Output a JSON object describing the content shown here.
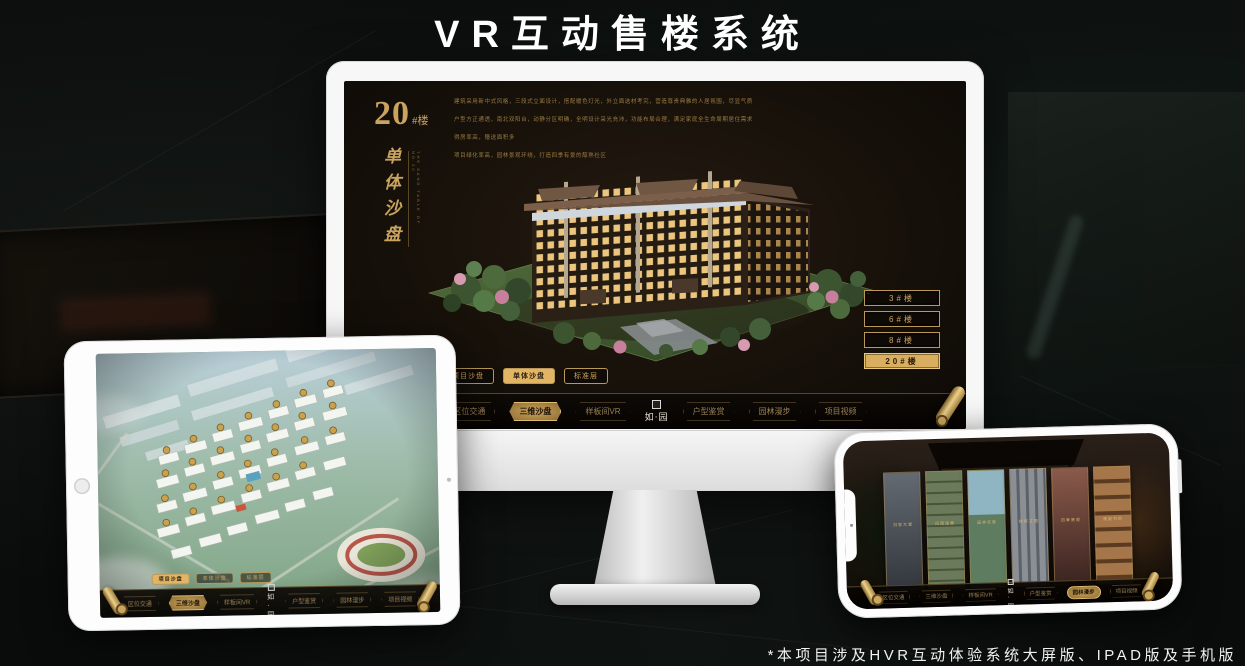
{
  "page": {
    "title": "VR互动售楼系统",
    "footnote": "*本项目涉及HVR互动体验系统大屏版、IPAD版及手机版"
  },
  "colors": {
    "gold": "#c9a45c",
    "gold_selected": "#e2b564",
    "screen_bg": "#17110a",
    "page_bg": "#0a0c0b"
  },
  "brand": {
    "logo": "如·园"
  },
  "nav": {
    "items_left": [
      "区位交通",
      "三维沙盘",
      "样板间VR"
    ],
    "items_right": [
      "户型鉴赏",
      "园林漫步",
      "项目视频"
    ]
  },
  "monitor": {
    "header": {
      "number": "20",
      "suffix": "#楼",
      "vertical_title": "单体沙盘",
      "vertical_subtitle_en": "THE SAND TABLE OF NO.20"
    },
    "description_lines": [
      "建筑采用新中式风格，三段式立面设计，搭配暖色灯光，外立面选材考究，营造尊贵典雅的人居氛围，尽显气质",
      "户型方正通透，南北双阳台，动静分区明确，全明设计采光充沛，功能布局合理，满足家庭全生命周期居住需求",
      "得房率高，赠送面积多",
      "项目绿化率高，园林景观环绕，打造四季有景的醇熟社区"
    ],
    "floor_buttons": [
      {
        "label": "3#楼",
        "selected": false
      },
      {
        "label": "6#楼",
        "selected": false
      },
      {
        "label": "8#楼",
        "selected": false
      },
      {
        "label": "20#楼",
        "selected": true
      }
    ],
    "sub_tabs": [
      {
        "label": "项目沙盘",
        "selected": false
      },
      {
        "label": "单体沙盘",
        "selected": true
      },
      {
        "label": "标准层",
        "selected": false
      }
    ],
    "nav_selected": "三维沙盘"
  },
  "ipad": {
    "sub_tabs": [
      {
        "label": "项目沙盘",
        "selected": true
      },
      {
        "label": "单体沙盘",
        "selected": false
      },
      {
        "label": "标准层",
        "selected": false
      }
    ],
    "nav_selected": "三维沙盘"
  },
  "phone": {
    "nav_selected": "园林漫步",
    "gallery_captions": [
      "归家大堂",
      "风雨连廊",
      "园林实景",
      "楼栋立面",
      "四季景观",
      "雅致书房"
    ]
  }
}
